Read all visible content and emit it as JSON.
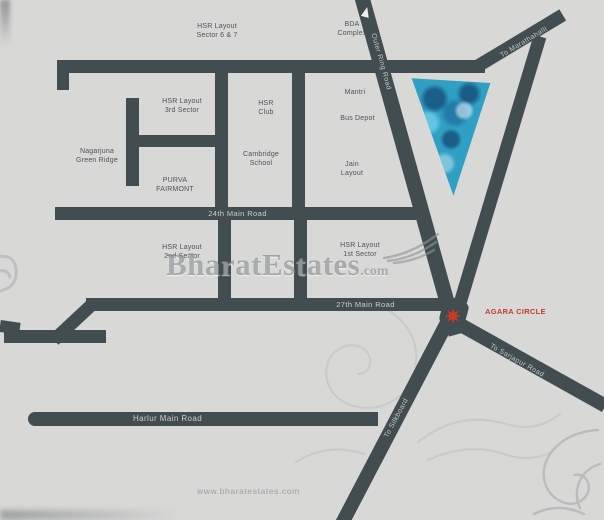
{
  "area_labels": [
    {
      "lines": [
        "HSR Layout",
        "Sector 6 & 7"
      ]
    },
    {
      "lines": [
        "BDA",
        "Complex"
      ]
    },
    {
      "lines": [
        "HSR Layout",
        "3rd Sector"
      ]
    },
    {
      "lines": [
        "HSR",
        "Club"
      ]
    },
    {
      "lines": [
        "Mantri"
      ]
    },
    {
      "lines": [
        "Bus Depot"
      ]
    },
    {
      "lines": [
        "Nagarjuna",
        "Green Ridge"
      ]
    },
    {
      "lines": [
        "Cambridge",
        "School"
      ]
    },
    {
      "lines": [
        "PURVA",
        "FAIRMONT"
      ]
    },
    {
      "lines": [
        "Jain",
        "Layout"
      ]
    },
    {
      "lines": [
        "HSR Layout",
        "2nd Sector"
      ]
    },
    {
      "lines": [
        "HSR Layout",
        "1st Sector"
      ]
    }
  ],
  "road_labels": {
    "outer_ring": "Outer Ring Road",
    "marathahalli": "To Marathahalli",
    "main24": "24th Main Road",
    "main27": "27th Main Road",
    "harlur": "Harlur Main Road",
    "silkboard": "To Silkboard",
    "sarjapur": "To Sarjapur Road"
  },
  "marker": {
    "label": "AGARA CIRCLE",
    "color": "#c23b2c"
  },
  "watermark": {
    "brand": "BharatEstates",
    "tld": ".com",
    "website": "www.bharatestates.com"
  },
  "colors": {
    "background": "#d8d9d7",
    "road": "#424d51",
    "road_text": "#c9d0d0",
    "area_text": "#4d5356",
    "site_triangle_blue": "#2f9fc4",
    "marker_red": "#c23b2c",
    "watermark_gray": "#62686b"
  }
}
